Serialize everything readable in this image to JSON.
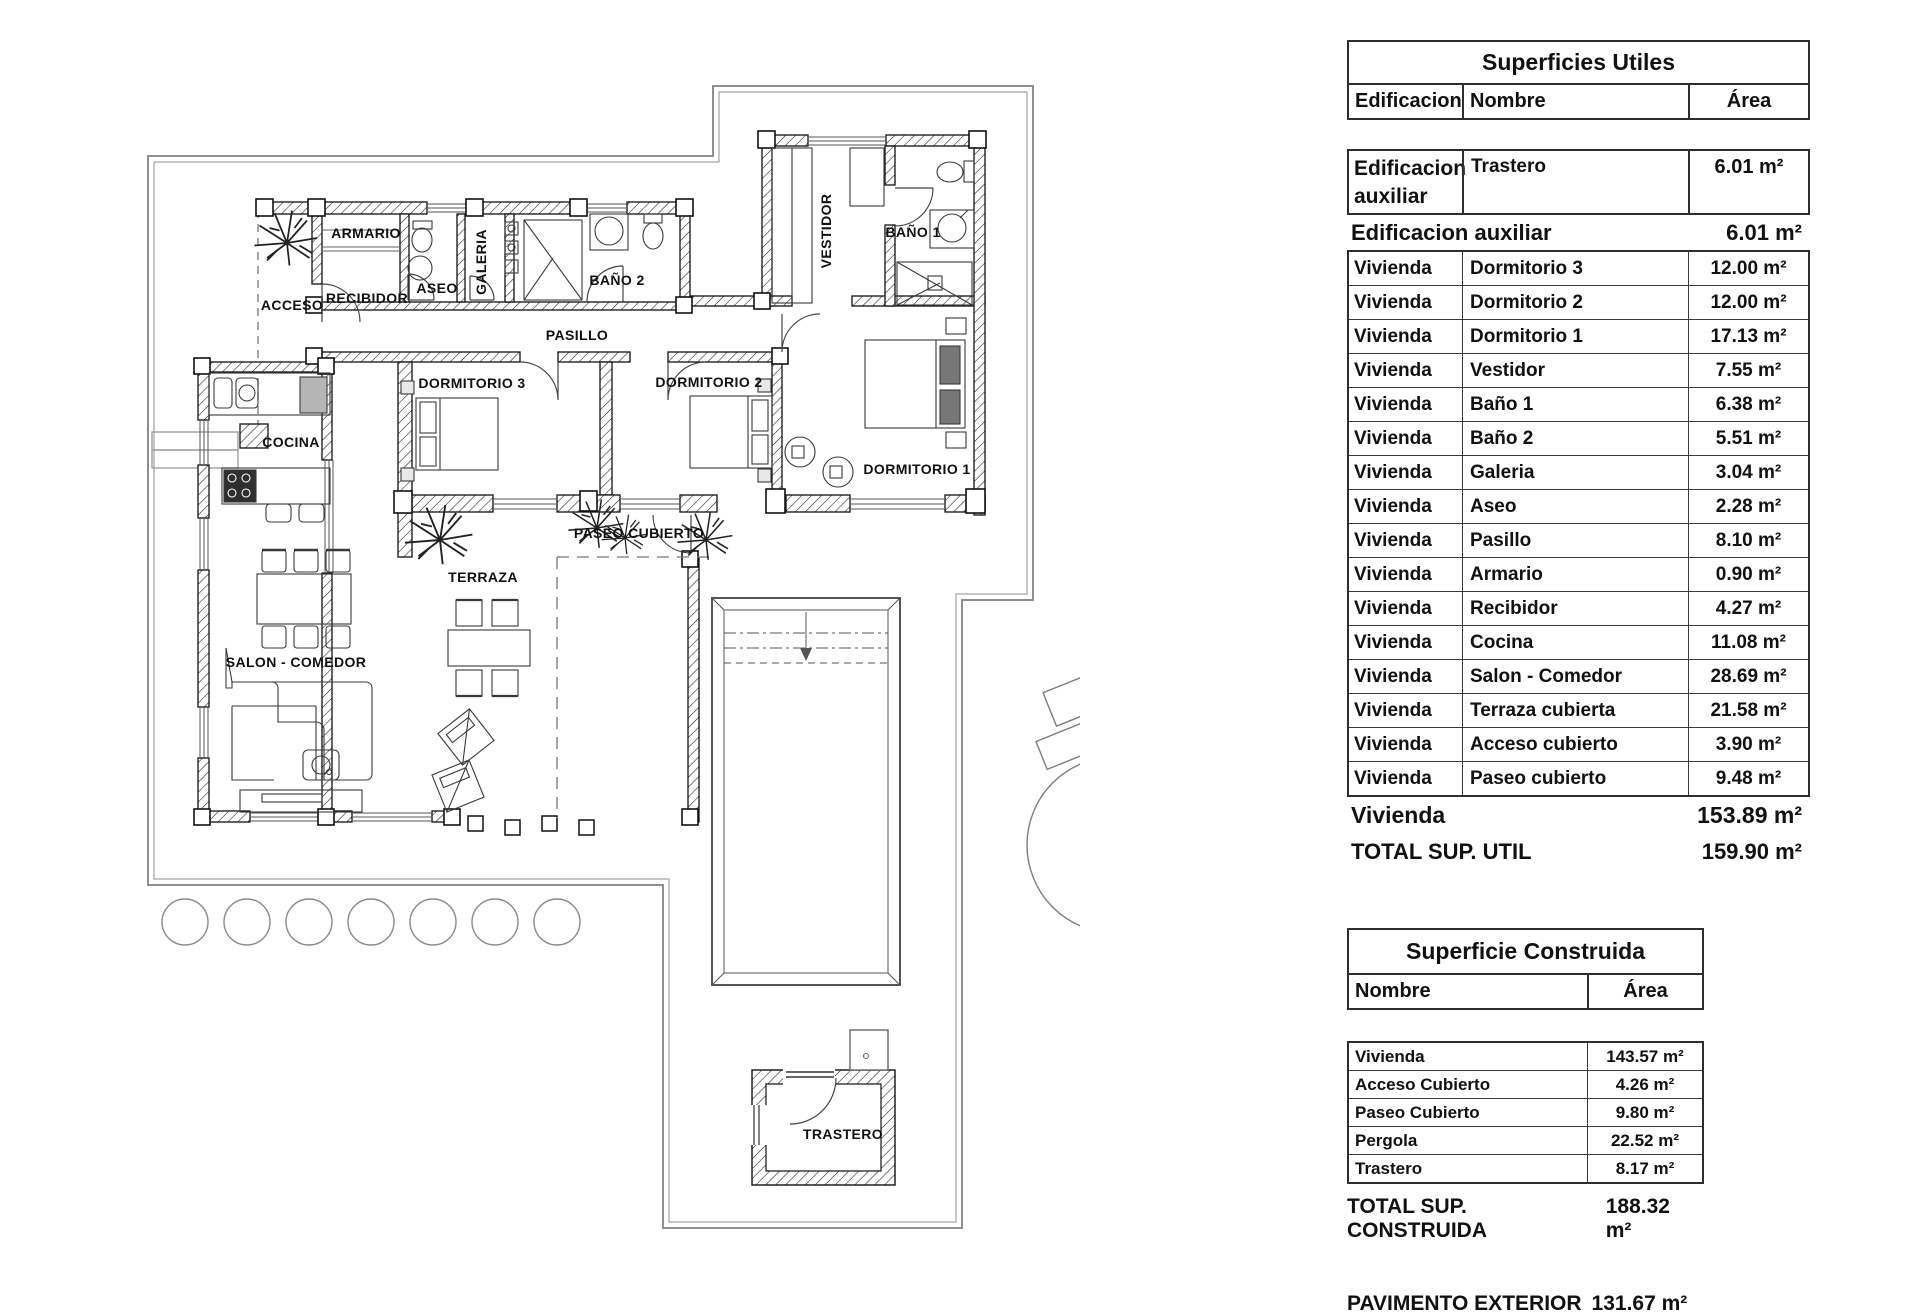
{
  "plan": {
    "labels": {
      "armario": "ARMARIO",
      "acceso": "ACCESO",
      "recibidor": "RECIBIDOR",
      "aseo": "ASEO",
      "galeria": "GALERIA",
      "bano2": "BAÑO 2",
      "pasillo": "PASILLO",
      "dormitorio3": "DORMITORIO 3",
      "dormitorio2": "DORMITORIO 2",
      "dormitorio1": "DORMITORIO 1",
      "vestidor": "VESTIDOR",
      "bano1": "BAÑO 1",
      "cocina": "COCINA",
      "salon": "SALON - COMEDOR",
      "terraza": "TERRAZA",
      "paseo": "PASEO CUBIERTO",
      "trastero": "TRASTERO"
    }
  },
  "tables": {
    "utiles": {
      "title": "Superficies Utiles",
      "headers": {
        "edificacion": "Edificacion",
        "nombre": "Nombre",
        "area": "Área"
      },
      "aux_row": {
        "edificacion": "Edificacion auxiliar",
        "nombre": "Trastero",
        "area": "6.01 m²"
      },
      "aux_subtotal": {
        "label": "Edificacion auxiliar",
        "value": "6.01 m²"
      },
      "rows": [
        {
          "e": "Vivienda",
          "n": "Dormitorio 3",
          "a": "12.00 m²"
        },
        {
          "e": "Vivienda",
          "n": "Dormitorio 2",
          "a": "12.00 m²"
        },
        {
          "e": "Vivienda",
          "n": "Dormitorio 1",
          "a": "17.13 m²"
        },
        {
          "e": "Vivienda",
          "n": "Vestidor",
          "a": "7.55 m²"
        },
        {
          "e": "Vivienda",
          "n": "Baño 1",
          "a": "6.38 m²"
        },
        {
          "e": "Vivienda",
          "n": "Baño 2",
          "a": "5.51 m²"
        },
        {
          "e": "Vivienda",
          "n": "Galeria",
          "a": "3.04 m²"
        },
        {
          "e": "Vivienda",
          "n": "Aseo",
          "a": "2.28 m²"
        },
        {
          "e": "Vivienda",
          "n": "Pasillo",
          "a": "8.10 m²"
        },
        {
          "e": "Vivienda",
          "n": "Armario",
          "a": "0.90 m²"
        },
        {
          "e": "Vivienda",
          "n": "Recibidor",
          "a": "4.27 m²"
        },
        {
          "e": "Vivienda",
          "n": "Cocina",
          "a": "11.08 m²"
        },
        {
          "e": "Vivienda",
          "n": "Salon - Comedor",
          "a": "28.69 m²"
        },
        {
          "e": "Vivienda",
          "n": "Terraza cubierta",
          "a": "21.58 m²"
        },
        {
          "e": "Vivienda",
          "n": "Acceso cubierto",
          "a": "3.90 m²"
        },
        {
          "e": "Vivienda",
          "n": "Paseo cubierto",
          "a": "9.48 m²"
        }
      ],
      "vivienda_subtotal": {
        "label": "Vivienda",
        "value": "153.89 m²"
      },
      "total": {
        "label": "TOTAL SUP. UTIL",
        "value": "159.90 m²"
      }
    },
    "construida": {
      "title": "Superficie Construida",
      "headers": {
        "nombre": "Nombre",
        "area": "Área"
      },
      "rows": [
        {
          "n": "Vivienda",
          "a": "143.57 m²"
        },
        {
          "n": "Acceso Cubierto",
          "a": "4.26 m²"
        },
        {
          "n": "Paseo Cubierto",
          "a": "9.80 m²"
        },
        {
          "n": "Pergola",
          "a": "22.52 m²"
        },
        {
          "n": "Trastero",
          "a": "8.17 m²"
        }
      ],
      "total": {
        "label": "TOTAL SUP. CONSTRUIDA",
        "value": "188.32 m²"
      },
      "pavimento": {
        "label": "PAVIMENTO EXTERIOR",
        "value": "131.67 m²"
      }
    }
  }
}
